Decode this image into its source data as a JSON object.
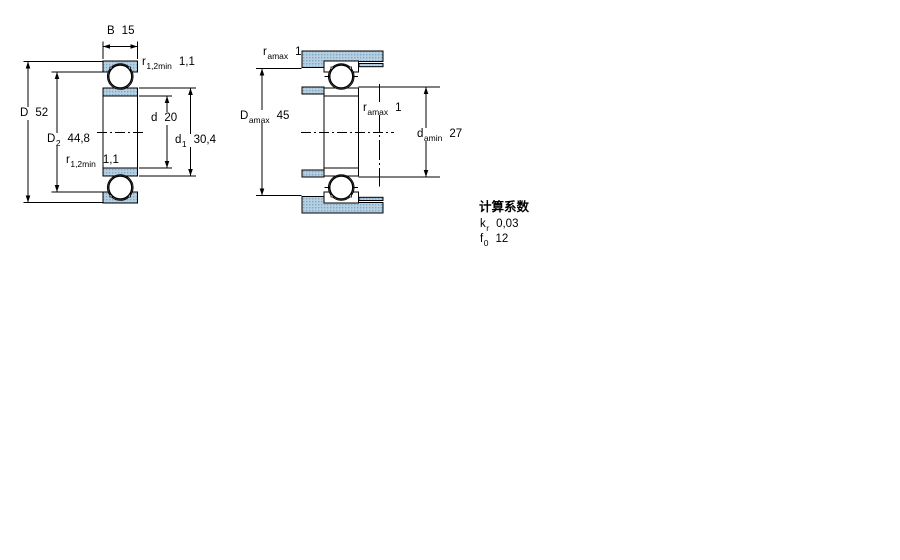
{
  "drawing": {
    "left_view": {
      "B": {
        "sym": "B",
        "val": "15"
      },
      "r_top": {
        "sym": "r",
        "sub": "1,2min",
        "val": "1,1"
      },
      "D": {
        "sym": "D",
        "val": "52"
      },
      "D2": {
        "sym": "D",
        "sub": "2",
        "val": "44,8"
      },
      "r_bottom": {
        "sym": "r",
        "sub": "1,2min",
        "val": "1,1"
      },
      "d": {
        "sym": "d",
        "val": "20"
      },
      "d1": {
        "sym": "d",
        "sub": "1",
        "val": "30,4"
      }
    },
    "right_view": {
      "ra_top": {
        "sym": "r",
        "sub": "amax",
        "val": "1"
      },
      "Da": {
        "sym": "D",
        "sub": "amax",
        "val": "45"
      },
      "ra_mid": {
        "sym": "r",
        "sub": "amax",
        "val": "1"
      },
      "da": {
        "sym": "d",
        "sub": "amin",
        "val": "27"
      }
    },
    "calculation_factors": {
      "title": "计算系数",
      "kr": {
        "sym": "k",
        "sub": "r",
        "val": "0,03"
      },
      "f0": {
        "sym": "f",
        "sub": "0",
        "val": "12"
      }
    },
    "colors": {
      "section_fill": "#b6d0e2",
      "section_dot": "#7fa8c6",
      "line": "#000000",
      "background": "#ffffff"
    }
  }
}
